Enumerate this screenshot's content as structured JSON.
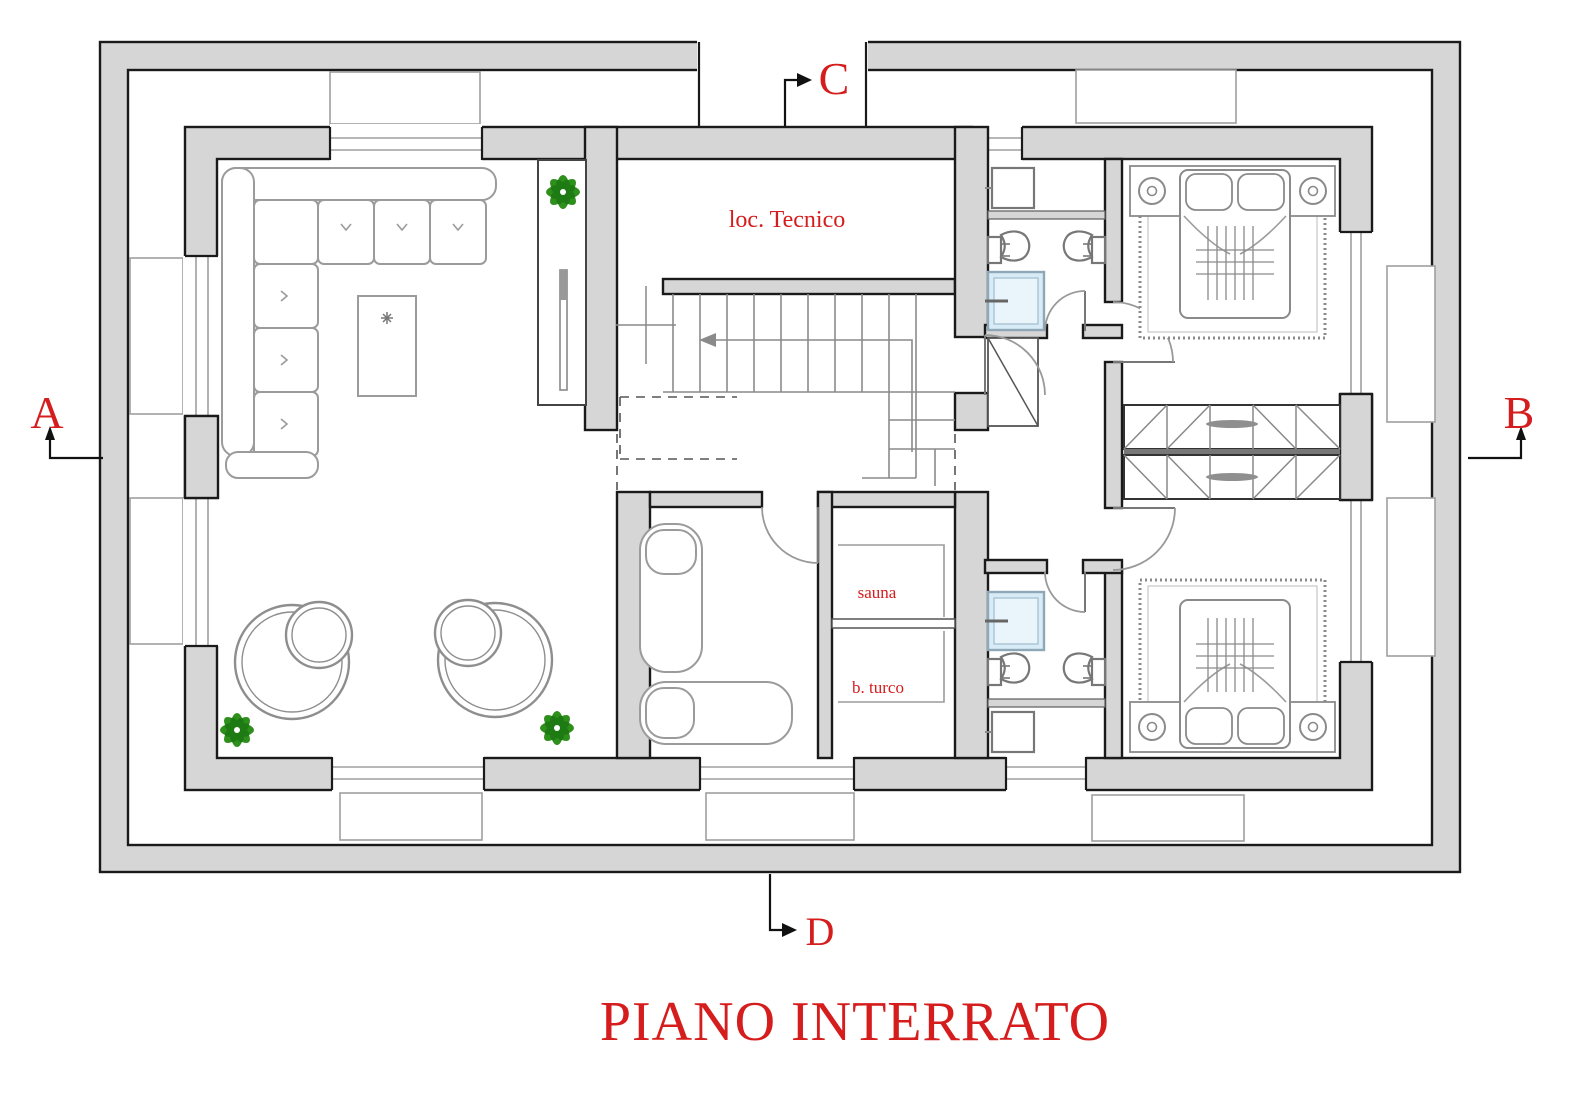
{
  "title": "PIANO INTERRATO",
  "section_markers": {
    "a": "A",
    "b": "B",
    "c": "C",
    "d": "D"
  },
  "room_labels": {
    "technical_room": "loc. Tecnico",
    "sauna": "sauna",
    "turkish_bath": "b. turco"
  },
  "colors": {
    "label_red": "#d61d1d",
    "wall_fill": "#d6d6d6",
    "wall_outline": "#1a1a1a",
    "furniture_line": "#9b9b9b",
    "plant_green": "#2e8f1c",
    "plant_green_dark": "#1e7a12",
    "shower_blue": "#d7ecf7"
  }
}
